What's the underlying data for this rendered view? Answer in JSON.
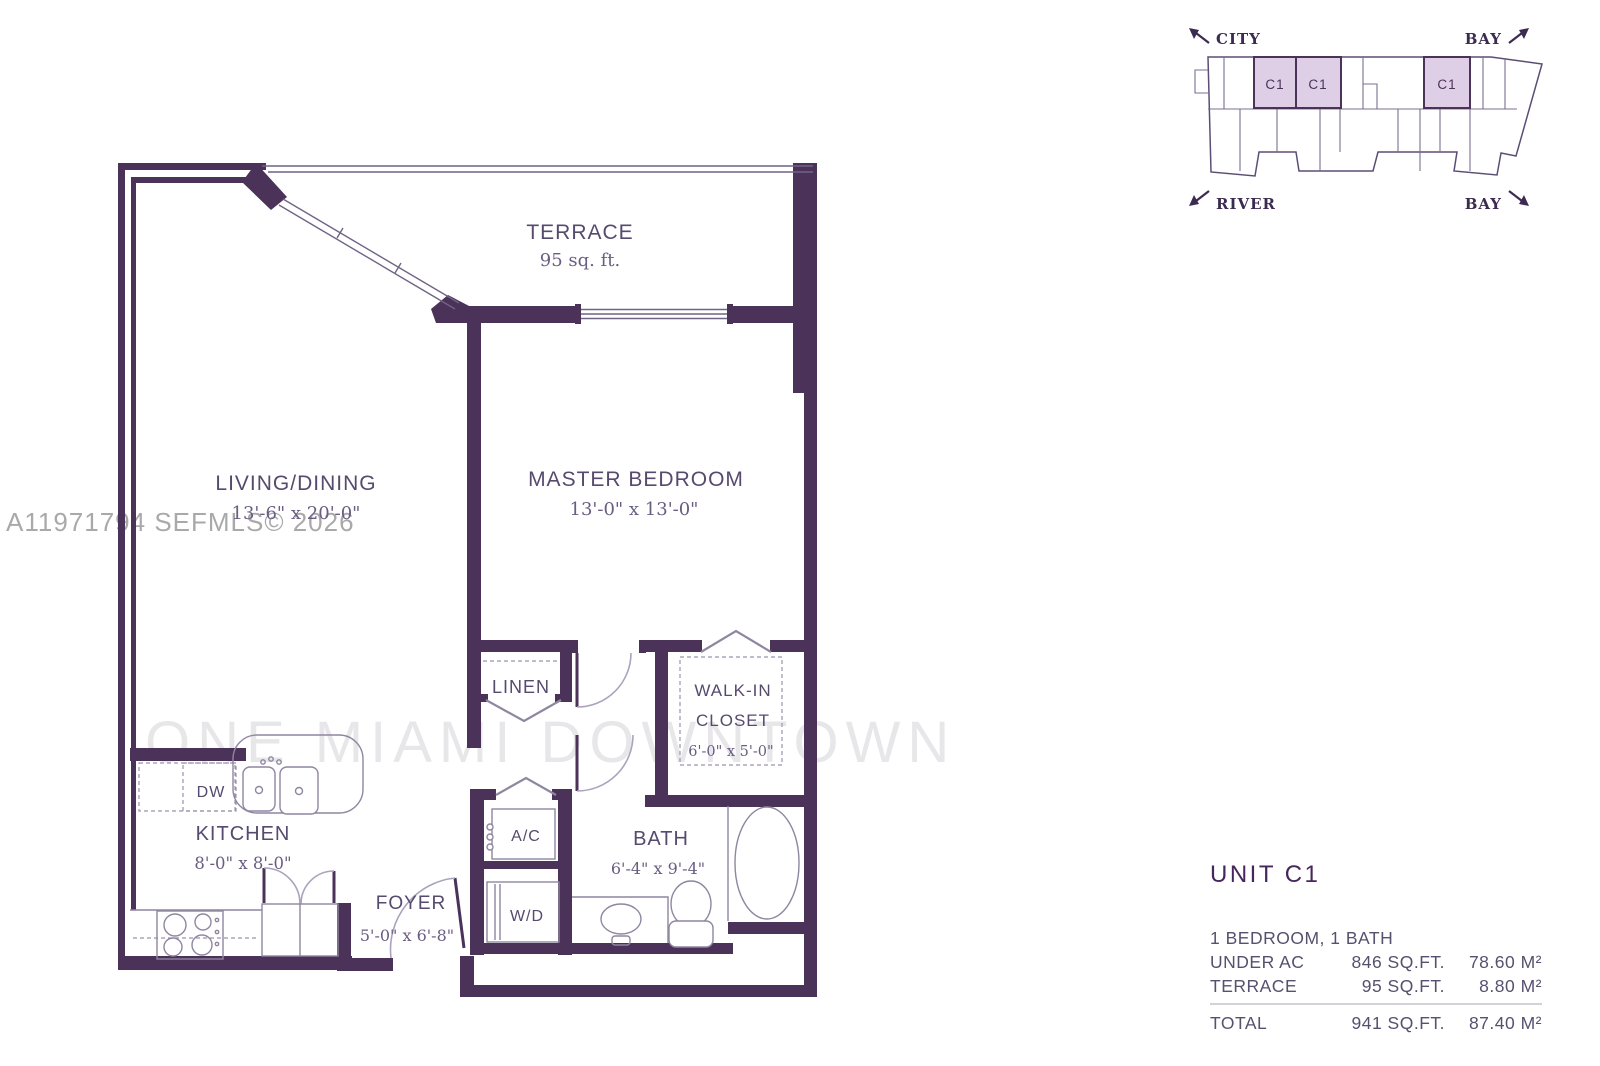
{
  "watermarks": {
    "mls": "A11971794 SEFMLS© 2026",
    "brand": "ONE MIAMI DOWNTOWN"
  },
  "keymap": {
    "top_left": "CITY",
    "top_right": "BAY",
    "bottom_left": "RIVER",
    "bottom_right": "BAY",
    "unit_label": "C1"
  },
  "floorplan": {
    "terrace": {
      "name": "TERRACE",
      "area": "95 sq. ft."
    },
    "living": {
      "name": "LIVING/DINING",
      "dims": "13'-6\" x 20'-0\""
    },
    "master": {
      "name": "MASTER BEDROOM",
      "dims": "13'-0\" x 13'-0\""
    },
    "linen": {
      "name": "LINEN"
    },
    "walkin": {
      "name1": "WALK-IN",
      "name2": "CLOSET",
      "dims": "6'-0\" x 5'-0\""
    },
    "kitchen": {
      "name": "KITCHEN",
      "dims": "8'-0\" x 8'-0\"",
      "dw": "DW"
    },
    "foyer": {
      "name": "FOYER",
      "dims": "5'-0\" x 6'-8\""
    },
    "ac": {
      "name": "A/C"
    },
    "wd": {
      "name": "W/D"
    },
    "bath": {
      "name": "BATH",
      "dims": "6'-4\" x 9'-4\""
    }
  },
  "info": {
    "title": "UNIT C1",
    "subtitle": "1 BEDROOM, 1 BATH",
    "rows": [
      {
        "label": "UNDER AC",
        "sqft": "846 SQ.FT.",
        "m2": "78.60 M²"
      },
      {
        "label": "TERRACE",
        "sqft": "95 SQ.FT.",
        "m2": "8.80 M²"
      },
      {
        "label": "TOTAL",
        "sqft": "941 SQ.FT.",
        "m2": "87.40 M²"
      }
    ]
  },
  "colors": {
    "wall": "#4b3259",
    "unit_fill": "#decfe7",
    "text": "#564a6e"
  }
}
